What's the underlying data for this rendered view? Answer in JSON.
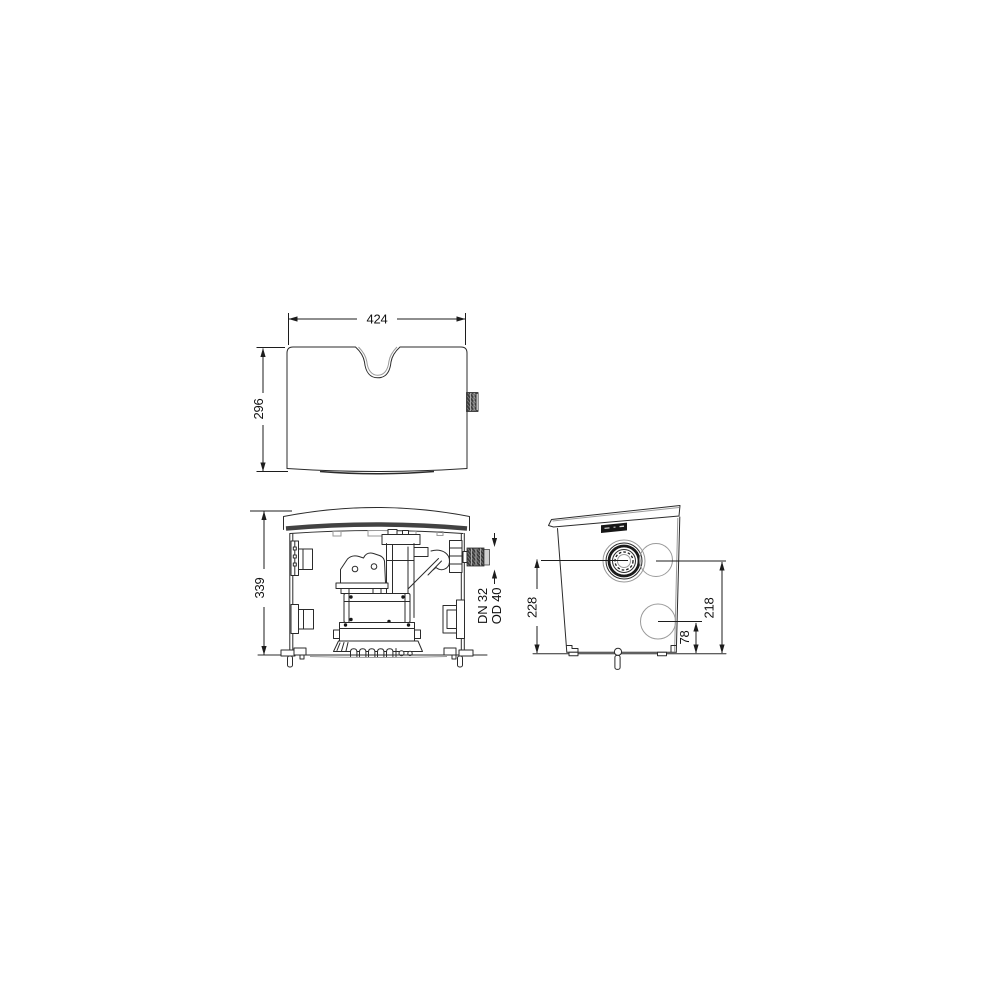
{
  "drawing": {
    "type": "technical-dimensional-drawing",
    "views": {
      "top": {
        "name": "top-view",
        "width_label": "424",
        "depth_label": "296"
      },
      "front": {
        "name": "front-section-view",
        "height_label": "339",
        "outlet_labels": [
          "DN 32",
          "OD 40"
        ]
      },
      "side": {
        "name": "side-view",
        "inlet_height_label": "228",
        "upper_opening_label": "218",
        "lower_opening_label": "78"
      }
    },
    "colors": {
      "line": "#2b2b2b",
      "dim_line": "#1c1c1c",
      "dark_fill": "#3c3c3c",
      "background": "#ffffff"
    }
  }
}
